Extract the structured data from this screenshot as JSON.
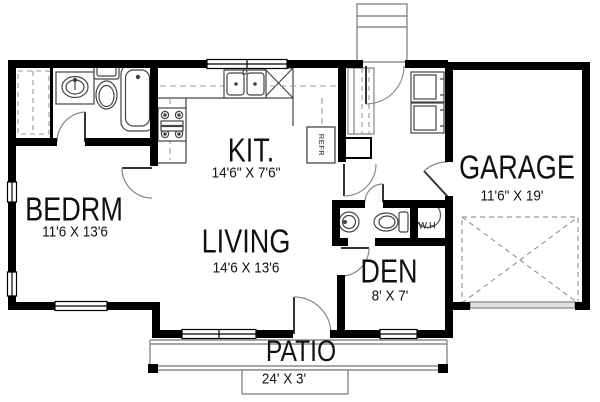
{
  "plan": {
    "title": "house-floor-plan",
    "rooms": {
      "bedroom": {
        "label": "BEDRM",
        "dimensions": "11'6 X 13'6"
      },
      "kitchen": {
        "label": "KIT.",
        "dimensions": "14'6\" X 7'6\""
      },
      "living": {
        "label": "LIVING",
        "dimensions": "14'6 X 13'6"
      },
      "den": {
        "label": "DEN",
        "dimensions": "8' X 7'"
      },
      "garage": {
        "label": "GARAGE",
        "dimensions": "11'6\" X 19'"
      },
      "patio": {
        "label": "PATIO",
        "dimensions": "24' X 3'"
      }
    },
    "fixtures": {
      "refrigerator": {
        "label": "REFR"
      },
      "water_heater": {
        "label": "W.H"
      }
    },
    "colors": {
      "wall": "#000000",
      "background": "#ffffff",
      "fixture_line": "#4a4a4a",
      "light_line": "#8a8a8a"
    }
  }
}
